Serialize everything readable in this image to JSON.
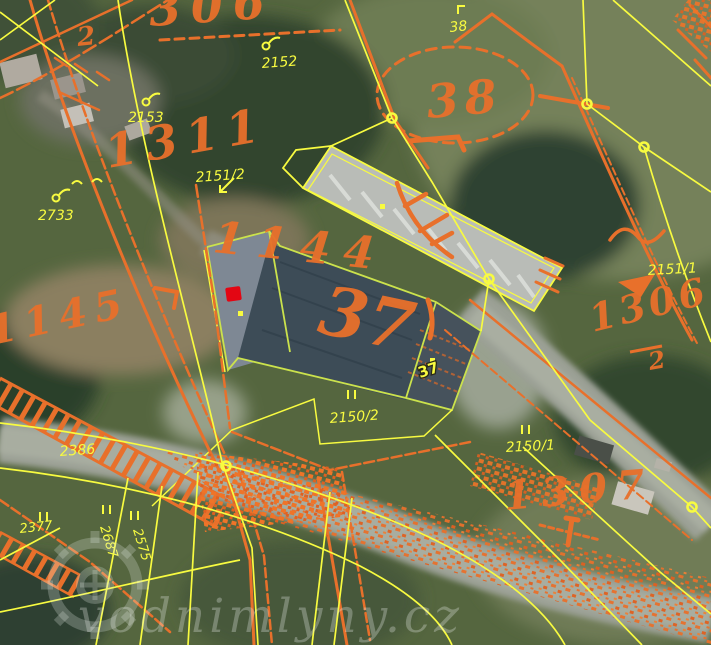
{
  "map": {
    "title": "cadastral-overlay-aerial-view",
    "watermark": {
      "text": "vodnimlyny.cz",
      "logo": "waterwheel-gear-icon"
    },
    "marker": {
      "name": "mill-location-marker",
      "color": "#e30613"
    },
    "colors": {
      "current_cadastre_lines": "#f8fb40",
      "old_cadastre_lines": "#e8702b",
      "building_outline_green": "#cbe24c",
      "road_gray": "#9ba095",
      "marker_red": "#e30613"
    },
    "labels": {
      "current": [
        {
          "text": "2153"
        },
        {
          "text": "2152"
        },
        {
          "text": "38"
        },
        {
          "text": "2151/2"
        },
        {
          "text": "2733"
        },
        {
          "text": "2151/1"
        },
        {
          "text": "2386"
        },
        {
          "text": "2150/2"
        },
        {
          "text": "2150/1"
        },
        {
          "text": "37"
        },
        {
          "text": "2377"
        },
        {
          "text": "2687"
        },
        {
          "text": "2575"
        }
      ],
      "old": [
        {
          "text": "306"
        },
        {
          "text": "2"
        },
        {
          "text": "1311"
        },
        {
          "text": "1144"
        },
        {
          "text": "1145"
        },
        {
          "text": "38"
        },
        {
          "text": "37"
        },
        {
          "text": "1306"
        },
        {
          "text": "2"
        },
        {
          "text": "1307"
        }
      ]
    },
    "symbols": {
      "vertex_node": "yellow-vertex-node",
      "double_tick": "boundary-double-tick",
      "circle_flag": "landuse-circle-flag-symbol",
      "arrow": "parcel-reference-arrow",
      "point_dot": "building-point-dot"
    }
  }
}
